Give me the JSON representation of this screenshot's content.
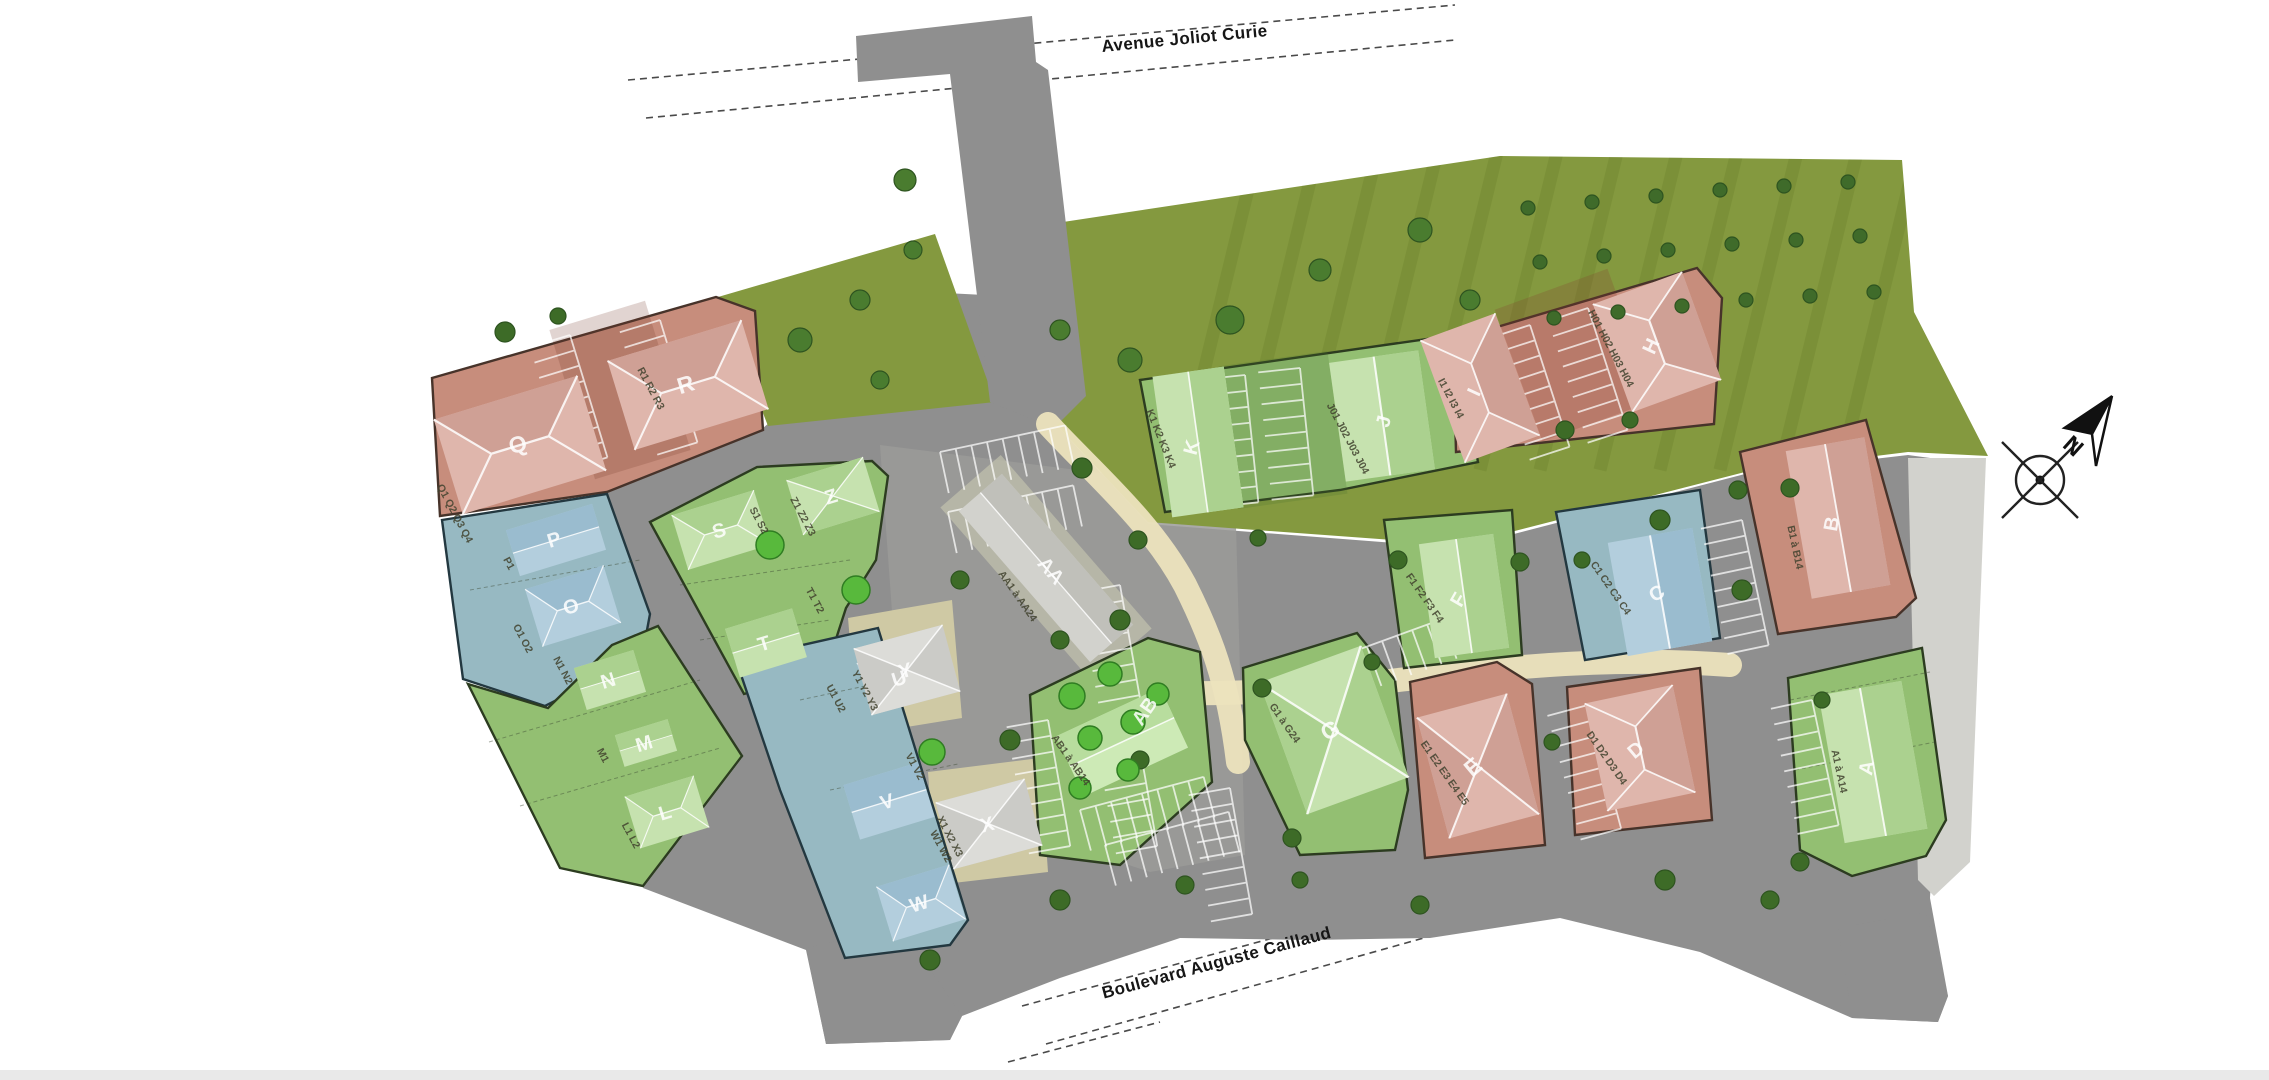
{
  "plan": {
    "type": "residential-masterplan-site-plan",
    "background": "#ffffff"
  },
  "streets": {
    "top": "Avenue Joliot Curie",
    "bottom": "Boulevard Auguste Caillaud"
  },
  "compass": {
    "north_label": "N"
  },
  "palette": {
    "zone_red": "#c78d7c",
    "zone_green": "#93bf72",
    "zone_blue": "#97b9c2",
    "road_gray": "#8f8f8f",
    "lawn_olive": "#84993f",
    "path_beige": "#ece3bd",
    "sidewalk_light": "#d2d2cd",
    "tree_dark": "#3f6b2a",
    "tree_bright": "#58b93c"
  },
  "buildings": [
    {
      "letter": "Q",
      "lots": "Q1 Q2 Q3 Q4"
    },
    {
      "letter": "R",
      "lots": "R1 R2 R3"
    },
    {
      "letter": "P",
      "lots": "P1"
    },
    {
      "letter": "O",
      "lots": "O1 O2"
    },
    {
      "letter": "N",
      "lots": "N1 N2"
    },
    {
      "letter": "M",
      "lots": "M1"
    },
    {
      "letter": "L",
      "lots": "L1 L2"
    },
    {
      "letter": "S",
      "lots": "S1 S2"
    },
    {
      "letter": "Z",
      "lots": "Z1 Z2 Z3"
    },
    {
      "letter": "T",
      "lots": "T1 T2"
    },
    {
      "letter": "U",
      "lots": "U1 U2"
    },
    {
      "letter": "V",
      "lots": "V1 V2"
    },
    {
      "letter": "W",
      "lots": "W1 W2"
    },
    {
      "letter": "Y",
      "lots": "Y1 Y2 Y3"
    },
    {
      "letter": "X",
      "lots": "X1 X2 X3"
    },
    {
      "letter": "AA",
      "lots": "AA1 à AA24"
    },
    {
      "letter": "AB",
      "lots": "AB1 à AB14"
    },
    {
      "letter": "K",
      "lots": "K1 K2 K3 K4"
    },
    {
      "letter": "J",
      "lots": "J01 J02 J03 J04"
    },
    {
      "letter": "I",
      "lots": "I1 I2 I3 I4"
    },
    {
      "letter": "H",
      "lots": "H01 H02 H03 H04"
    },
    {
      "letter": "B",
      "lots": "B1 à B14"
    },
    {
      "letter": "C",
      "lots": "C1 C2 C3 C4"
    },
    {
      "letter": "F",
      "lots": "F1 F2 F3 F4"
    },
    {
      "letter": "G",
      "lots": "G1 à G24"
    },
    {
      "letter": "E",
      "lots": "E1 E2 E3 E4 E5"
    },
    {
      "letter": "D",
      "lots": "D1 D2 D3 D4"
    },
    {
      "letter": "A",
      "lots": "A1 à A14"
    }
  ]
}
